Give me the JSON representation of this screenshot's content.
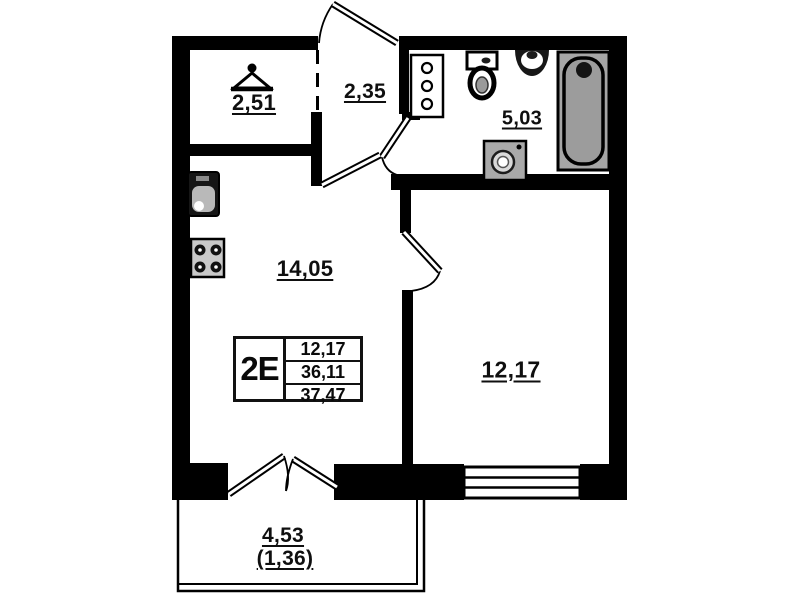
{
  "plan": {
    "title": "apartment floor plan",
    "rooms": {
      "wardrobe": {
        "area": "2,51"
      },
      "hallway": {
        "area": "2,35"
      },
      "bathroom": {
        "area": "5,03"
      },
      "kitchen_living": {
        "area": "14,05"
      },
      "bedroom": {
        "area": "12,17"
      },
      "balcony": {
        "area": "4,53",
        "area_reduced": "(1,36)"
      }
    },
    "info_box": {
      "type_label": "2E",
      "rows": [
        "12,17",
        "36,11",
        "37,47"
      ]
    },
    "fixtures": {
      "wardrobe": [
        "hanger-icon"
      ],
      "kitchen": [
        "sink-icon",
        "stove-icon"
      ],
      "bathroom": [
        "shelf-cabinet-icon",
        "toilet-icon",
        "washbasin-icon",
        "washing-machine-icon",
        "bathtub-icon"
      ]
    },
    "colors": {
      "wall": "#000000",
      "background": "#ffffff",
      "fixture_gray": "#a6a6a6"
    }
  }
}
